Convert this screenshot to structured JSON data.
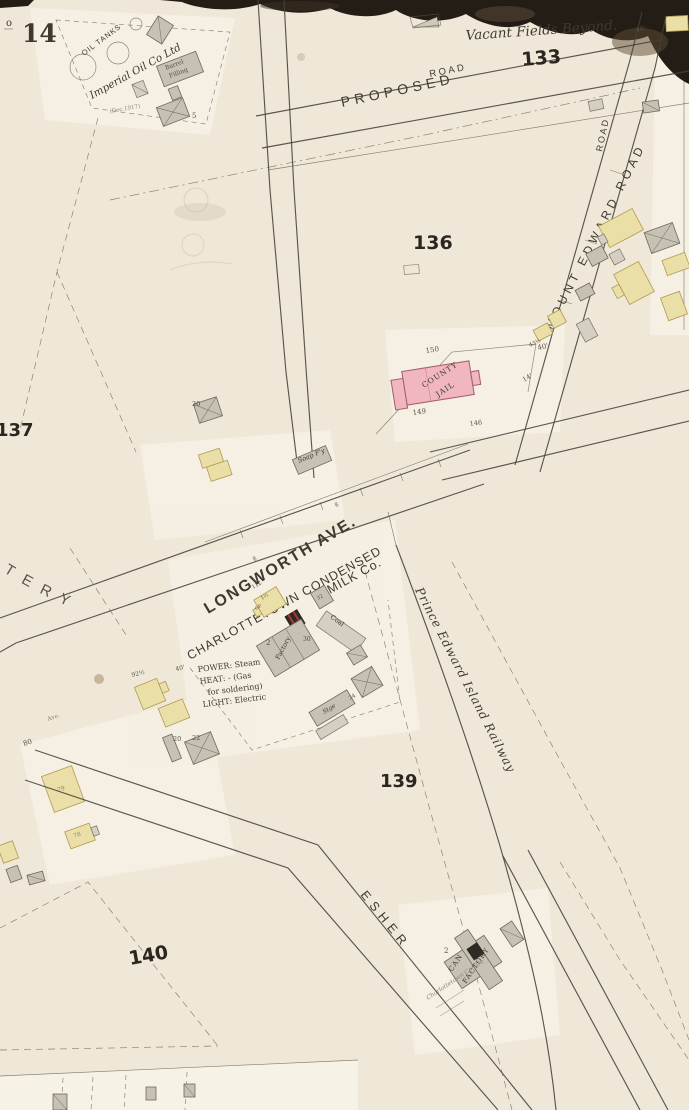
{
  "palette": {
    "paper": "#efe8d9",
    "paper_light": "#f9f5ea",
    "ink": "#46413a",
    "torn_edge": "#241d15",
    "building_yellow": "#eadfa6",
    "building_gray": "#c6c1b4",
    "building_pink": "#f0b7c0",
    "boiler_red": "#a93a2f",
    "block_number": "#2b2620"
  },
  "sheet": {
    "corner_mark": "o",
    "number": "14"
  },
  "blocks": {
    "b133": "133",
    "b136": "136",
    "b137": "137",
    "b139": "139",
    "b140": "140"
  },
  "streets": {
    "proposed": "PROPOSED",
    "road_upper": "ROAD",
    "road_side": "ROAD",
    "mount_edward": "MOUNT EDWARD ROAD",
    "longworth": "LONGWORTH AVE.",
    "railway": "Prince Edward Island Railway",
    "esher": "ESHER",
    "cemetery_partial": "ETERY",
    "ave_small": "Ave."
  },
  "notes": {
    "vacant_fields": "Vacant Fields Beyond.",
    "date_note": "(Dec.1917)"
  },
  "oil_works": {
    "tanks_label": "OIL TANKS",
    "company": "Imperial Oil Co Ltd",
    "barrel_1": "Barrel",
    "barrel_2": "Filling",
    "num_5": "5"
  },
  "jail": {
    "line1": "COUNTY",
    "line2": "JAIL",
    "n150": "150",
    "n149": "149",
    "n146": "146",
    "d40": "40'",
    "d14": "14'"
  },
  "milk_co": {
    "title1": "CHARLOTTETOWN CONDENSED",
    "title2": "MILK Co.",
    "power": "POWER: Steam",
    "heat1": "HEAT:  -  (Gas",
    "heat2": "for soldering)",
    "light": "LIGHT: Electric",
    "factory": "Factory",
    "coal": "Coal",
    "stge": "Stge",
    "n112": "112",
    "n30": "30",
    "n2": "2",
    "n32": "32",
    "n34": "34",
    "story": "1½",
    "op": "OP"
  },
  "can_factory": {
    "line1": "CAN",
    "line2": "FACTORY",
    "company": "Charlottetown Can Co",
    "story": "2"
  },
  "soap": {
    "label": "Soap F'y"
  },
  "lots": {
    "n80": "80",
    "n92": "92½",
    "d40": "40'",
    "n20": "20",
    "n20b": "20",
    "n22": "22",
    "n79": "79",
    "n78": "78",
    "n8a": "8",
    "n8b": "8",
    "n43": "43½",
    "d40b": "40'"
  }
}
